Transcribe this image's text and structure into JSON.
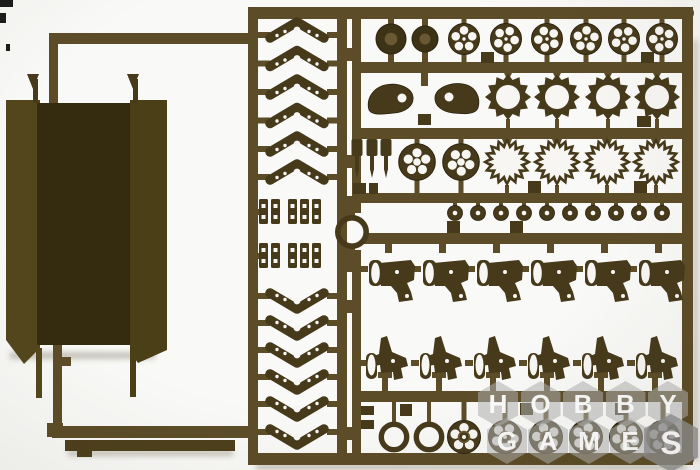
{
  "scene": {
    "background": "#f9f9f7"
  },
  "palette": {
    "runner": "#5c4c27",
    "runner_edge": "#3a2f13",
    "part": "#463a1b",
    "part_dark": "#3c3216",
    "part_edge": "#2d2410",
    "hub": "#6a5832",
    "hole": "#f7f6f3",
    "panel_left": "#54461c",
    "panel_center": "#352c10",
    "panel_right": "#4b3f17",
    "flat": "#4d3f1b",
    "shadow": "rgba(80,70,45,0.30)",
    "mark": "#1b1b1b"
  },
  "sprue": {
    "runners": [
      [
        52,
        33,
        198,
        11,
        0,
        "left-top-runner"
      ],
      [
        49,
        33,
        9,
        70,
        0,
        "left-top-stub"
      ],
      [
        53,
        345,
        9,
        88,
        0,
        "left-vert-runner"
      ],
      [
        62,
        357,
        9,
        9,
        0,
        "left-side-tab"
      ],
      [
        47,
        423,
        16,
        14,
        0,
        "left-elbow"
      ],
      [
        52,
        426,
        200,
        12,
        0,
        "left-bottom-runner"
      ],
      [
        248,
        7,
        10,
        458,
        0,
        "ladder-left-rail"
      ],
      [
        337,
        7,
        10,
        450,
        0,
        "ladder-right-rail"
      ],
      [
        248,
        7,
        446,
        12,
        6,
        "top-rail"
      ],
      [
        248,
        453,
        446,
        12,
        6,
        "bottom-rail"
      ],
      [
        352,
        7,
        9,
        206,
        0,
        "grid-left-rail-upper"
      ],
      [
        352,
        250,
        9,
        214,
        0,
        "grid-left-rail-lower"
      ],
      [
        682,
        7,
        11,
        458,
        0,
        "grid-right-rail"
      ],
      [
        352,
        62,
        341,
        11,
        0,
        "grid-rail-1"
      ],
      [
        352,
        128,
        341,
        11,
        0,
        "grid-rail-2"
      ],
      [
        352,
        193,
        341,
        10,
        0,
        "grid-rail-3"
      ],
      [
        364,
        233,
        329,
        11,
        0,
        "grid-rail-4"
      ],
      [
        352,
        391,
        341,
        11,
        0,
        "grid-rail-5"
      ],
      [
        345,
        196,
        10,
        22,
        0,
        "ring-stub-top"
      ],
      [
        345,
        245,
        10,
        27,
        0,
        "ring-stub-bottom"
      ]
    ],
    "rail_tabs": [
      [
        346,
        48,
        9,
        13
      ],
      [
        346,
        155,
        9,
        13
      ],
      [
        346,
        300,
        9,
        13
      ],
      [
        346,
        427,
        9,
        13
      ]
    ],
    "panels": {
      "left_pts": "6,100 40,100 40,348 24,364 6,340",
      "left_tail": [
        36,
        348,
        6,
        50
      ],
      "center": [
        37,
        103,
        94,
        242
      ],
      "right_pts": "130,100 167,100 167,350 138,363 130,352",
      "right_tail": [
        130,
        350,
        6,
        47
      ]
    },
    "prongs": [
      {
        "stem": [
          33,
          79,
          5,
          24
        ],
        "head": "27,74 39,74 33,89"
      },
      {
        "stem": [
          133,
          79,
          5,
          24
        ],
        "head": "127,74 139,74 133,89"
      }
    ],
    "flat_bar": {
      "bar": [
        65,
        440,
        170,
        11
      ],
      "tab": [
        77,
        450,
        15,
        7
      ]
    },
    "chevrons": {
      "cx": 297,
      "top_cys": [
        31,
        59.5,
        88,
        116.5,
        145,
        173
      ],
      "bottom_cys": [
        300,
        327,
        354,
        381,
        408,
        436
      ]
    },
    "clips": {
      "row_ys": [
        199,
        243
      ],
      "xs": [
        259,
        271,
        288,
        300,
        312
      ]
    },
    "ring_part": {
      "cx": 352,
      "cy": 232,
      "r": 14.2,
      "band": 5.6
    },
    "row1": {
      "solid": [
        {
          "cx": 391,
          "cy": 39,
          "r": 15
        },
        {
          "cx": 425,
          "cy": 39,
          "r": 13
        }
      ],
      "spoked_cxs": [
        464,
        506,
        547,
        586,
        624,
        662
      ],
      "cy": 39,
      "r": 15.5,
      "tabs": [
        [
          481,
          52,
          13,
          11
        ],
        [
          641,
          52,
          13,
          11
        ]
      ]
    },
    "row2": {
      "teardrops": [
        "M369,110 C366,100 372,88 385,85 C399,82 412,88 413,97 C414,106 405,112 394,113 C384,114 372,116 369,110 Z",
        "M478,108 C481,98 476,86 463,84 C450,82 436,88 435,97 C434,106 443,112 453,113 C464,114 475,115 478,108 Z"
      ],
      "teardrop_holes": [
        [
          402,
          98
        ],
        [
          449,
          97
        ]
      ],
      "stub": [
        421,
        72,
        7,
        14
      ],
      "sprocket_cxs": [
        508,
        557,
        608,
        657
      ],
      "cy": 97,
      "teeth": 12,
      "R": 23,
      "r": 17.6,
      "hole_r": 12,
      "tabs": [
        [
          418,
          114,
          13,
          11
        ],
        [
          637,
          116,
          14,
          11
        ]
      ]
    },
    "row3": {
      "pin_xs": [
        357,
        372,
        386
      ],
      "spoked_cxs": [
        417,
        461
      ],
      "cy": 162,
      "r": 18.3,
      "star_cxs": [
        507,
        557,
        607,
        656
      ],
      "points": 16,
      "R": 24.5,
      "iR": 19.3,
      "ir": 13,
      "tabs": [
        [
          353,
          183,
          13,
          11
        ],
        [
          369,
          183,
          9,
          11
        ],
        [
          528,
          181,
          13,
          12
        ],
        [
          634,
          181,
          13,
          12
        ]
      ]
    },
    "row4": {
      "cxs": [
        455,
        478,
        501,
        524,
        547,
        570,
        593,
        616,
        639,
        662
      ],
      "cy": 213,
      "r": 7.5,
      "tabs": [
        [
          447,
          221,
          13,
          12
        ],
        [
          510,
          221,
          13,
          12
        ]
      ]
    },
    "row5": {
      "lefts": [
        367,
        421,
        475,
        529,
        583,
        637
      ],
      "top": 250,
      "path": "M2,14 L44,10 L48,16 L47,30 L40,33 L44,42 L46,50 L32,52 L30,43 L24,36 L14,36 L13,30 L3,32 Z"
    },
    "row6": {
      "lefts": [
        365,
        419,
        473,
        527,
        581,
        635
      ],
      "top": 334,
      "path": "M4,24 L14,20 L16,4 L22,2 L27,18 L41,24 L43,32 L36,34 L38,44 L29,46 L28,38 L16,39 L15,31 L3,33 Z"
    },
    "row7": {
      "ring_cxs": [
        394,
        429
      ],
      "spoked_cxs": [
        464,
        505,
        546,
        586,
        626,
        663
      ],
      "cy": 437,
      "r": 16.5,
      "left_tabs": [
        [
          361,
          406,
          13,
          9
        ],
        [
          361,
          420,
          13,
          9
        ]
      ],
      "tabs": [
        [
          400,
          404,
          12,
          12
        ],
        [
          520,
          403,
          13,
          12
        ],
        [
          615,
          403,
          13,
          12
        ]
      ]
    },
    "shadows": [
      [
        256,
        464,
        430,
        6
      ],
      [
        68,
        450,
        165,
        6
      ],
      [
        10,
        352,
        145,
        7
      ],
      [
        693,
        40,
        5,
        420
      ]
    ],
    "corner_marks": [
      [
        0,
        0,
        13,
        7
      ],
      [
        0,
        13,
        6,
        10
      ],
      [
        6,
        44,
        4,
        7
      ]
    ]
  },
  "watermark": {
    "text": "HOBBY GAMES",
    "rows": [
      {
        "letters": [
          "H",
          "O",
          "B",
          "B",
          "Y"
        ],
        "x0": 478,
        "y": 381,
        "dx": 42.5,
        "w": 40,
        "h": 46,
        "fs": 26,
        "big_last": false
      },
      {
        "letters": [
          "G",
          "A",
          "M",
          "E",
          "S"
        ],
        "x0": 487,
        "y": 418,
        "dx": 41,
        "w": 40,
        "h": 46,
        "fs": 26,
        "big_last": true
      }
    ],
    "tile_color": "rgba(177,177,177,0.55)",
    "tile_color_big": "rgba(143,143,143,0.80)",
    "letter_color": "rgba(255,255,255,0.95)"
  }
}
